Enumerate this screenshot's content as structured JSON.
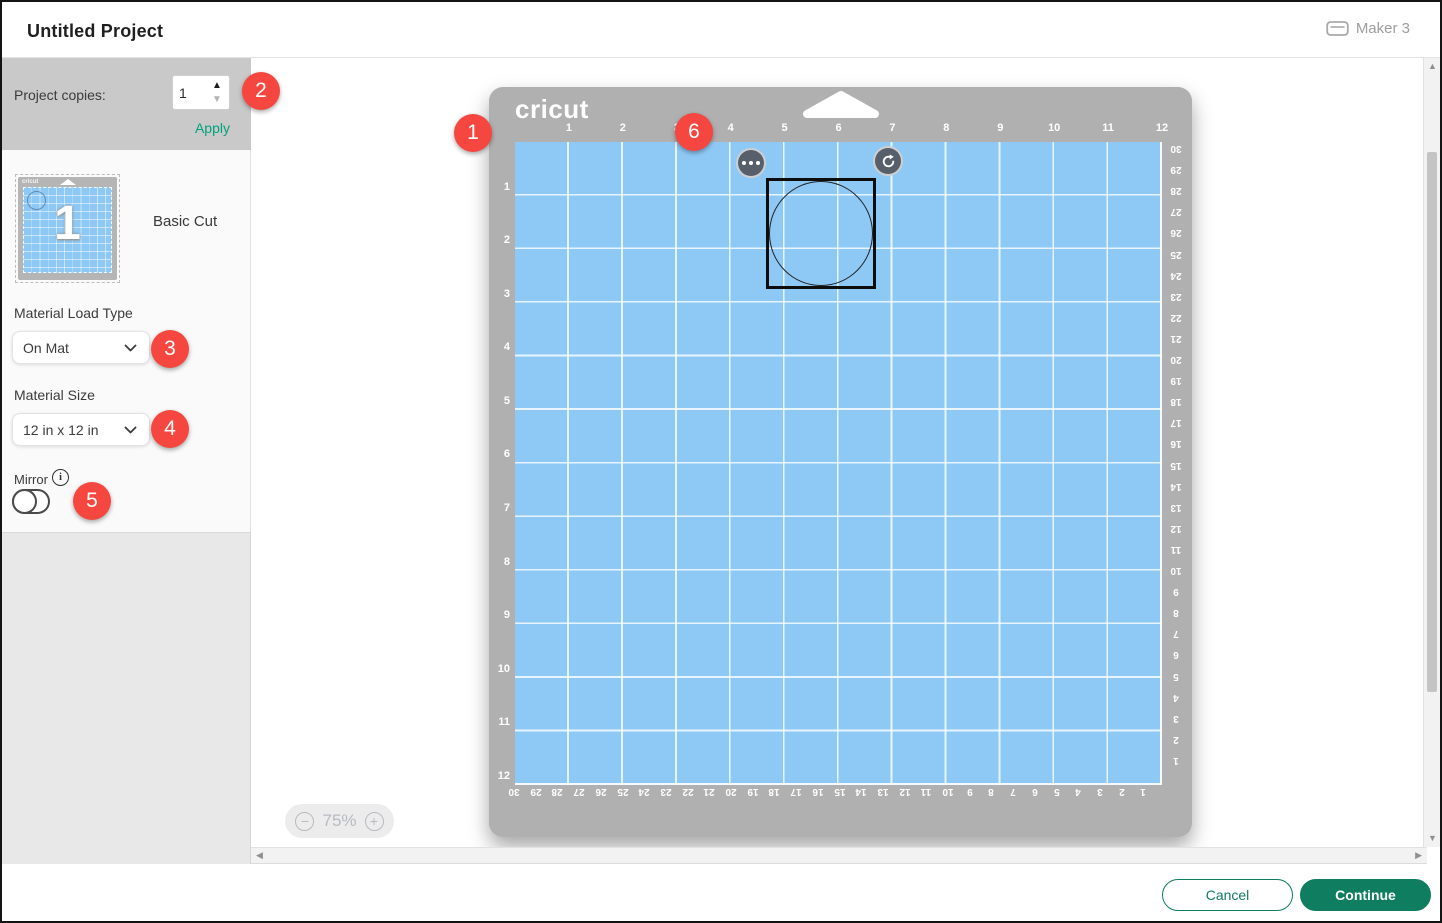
{
  "header": {
    "title": "Untitled Project",
    "machine_label": "Maker 3"
  },
  "sidebar": {
    "project_copies_label": "Project copies:",
    "copies_value": "1",
    "apply_label": "Apply",
    "mat_thumbnail_number": "1",
    "linetype_label": "Basic Cut",
    "material_load_type_label": "Material Load Type",
    "material_load_type_value": "On Mat",
    "material_size_label": "Material Size",
    "material_size_value": "12 in x 12 in",
    "mirror_label": "Mirror",
    "info_icon_glyph": "i"
  },
  "callouts": [
    "1",
    "2",
    "3",
    "4",
    "5",
    "6"
  ],
  "mat": {
    "brand": "cricut",
    "top_ruler_in": [
      "1",
      "2",
      "3",
      "4",
      "5",
      "6",
      "7",
      "8",
      "9",
      "10",
      "11",
      "12"
    ],
    "left_ruler_in": [
      "1",
      "2",
      "3",
      "4",
      "5",
      "6",
      "7",
      "8",
      "9",
      "10",
      "11",
      "12"
    ],
    "right_ruler_cm": [
      "30",
      "29",
      "28",
      "27",
      "26",
      "25",
      "24",
      "23",
      "22",
      "21",
      "20",
      "19",
      "18",
      "17",
      "16",
      "15",
      "14",
      "13",
      "12",
      "11",
      "10",
      "9",
      "8",
      "7",
      "6",
      "5",
      "4",
      "3",
      "2",
      "1"
    ],
    "bottom_ruler_cm": [
      "30",
      "29",
      "28",
      "27",
      "26",
      "25",
      "24",
      "23",
      "22",
      "21",
      "20",
      "19",
      "18",
      "17",
      "16",
      "15",
      "14",
      "13",
      "12",
      "11",
      "10",
      "9",
      "8",
      "7",
      "6",
      "5",
      "4",
      "3",
      "2",
      "1"
    ]
  },
  "zoom_control": {
    "minus": "−",
    "value": "75%",
    "plus": "+"
  },
  "footer": {
    "cancel_label": "Cancel",
    "continue_label": "Continue"
  },
  "colors": {
    "accent-green": "#0f7d5f",
    "apply-green": "#00a17c",
    "badge-red": "#f5473f",
    "mat-blue": "#8ec9f5",
    "frame-gray": "#b0b0b0"
  }
}
